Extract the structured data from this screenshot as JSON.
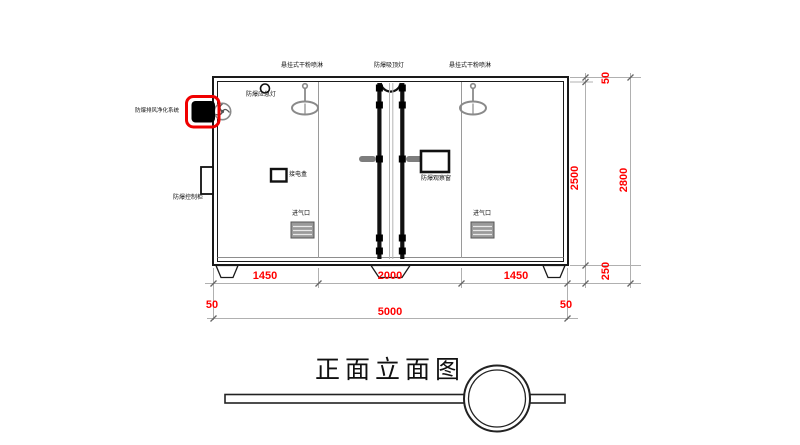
{
  "drawing": {
    "title": "正面立面图",
    "equipment_labels": {
      "sprinkler_left": "悬挂式干粉喷淋",
      "ceiling_light": "防爆吸顶灯",
      "sprinkler_right": "悬挂式干粉喷淋",
      "emergency_light": "防爆应急灯",
      "exhaust_purifier": "防爆排风净化系统",
      "control_cabinet": "防爆控制柜",
      "junction_box": "接电盒",
      "observation_window": "防爆观察窗",
      "air_inlet_left": "进气口",
      "air_inlet_right": "进气口"
    },
    "dimensions": {
      "bay_left": "1450",
      "bay_center": "2000",
      "bay_right": "1450",
      "offset_bottom_left": "50",
      "overall_width": "5000",
      "offset_bottom_right": "50",
      "offset_top_right": "50",
      "body_height": "2500",
      "overall_height": "2800",
      "base_height": "250"
    },
    "colors": {
      "dimension_red": "#ff0000",
      "highlight_red": "#f00000",
      "line_black": "#111111",
      "line_gray": "#aaaaaa",
      "equipment_gray": "#8a8a8a",
      "vent_fill": "#9a9a9a"
    }
  }
}
